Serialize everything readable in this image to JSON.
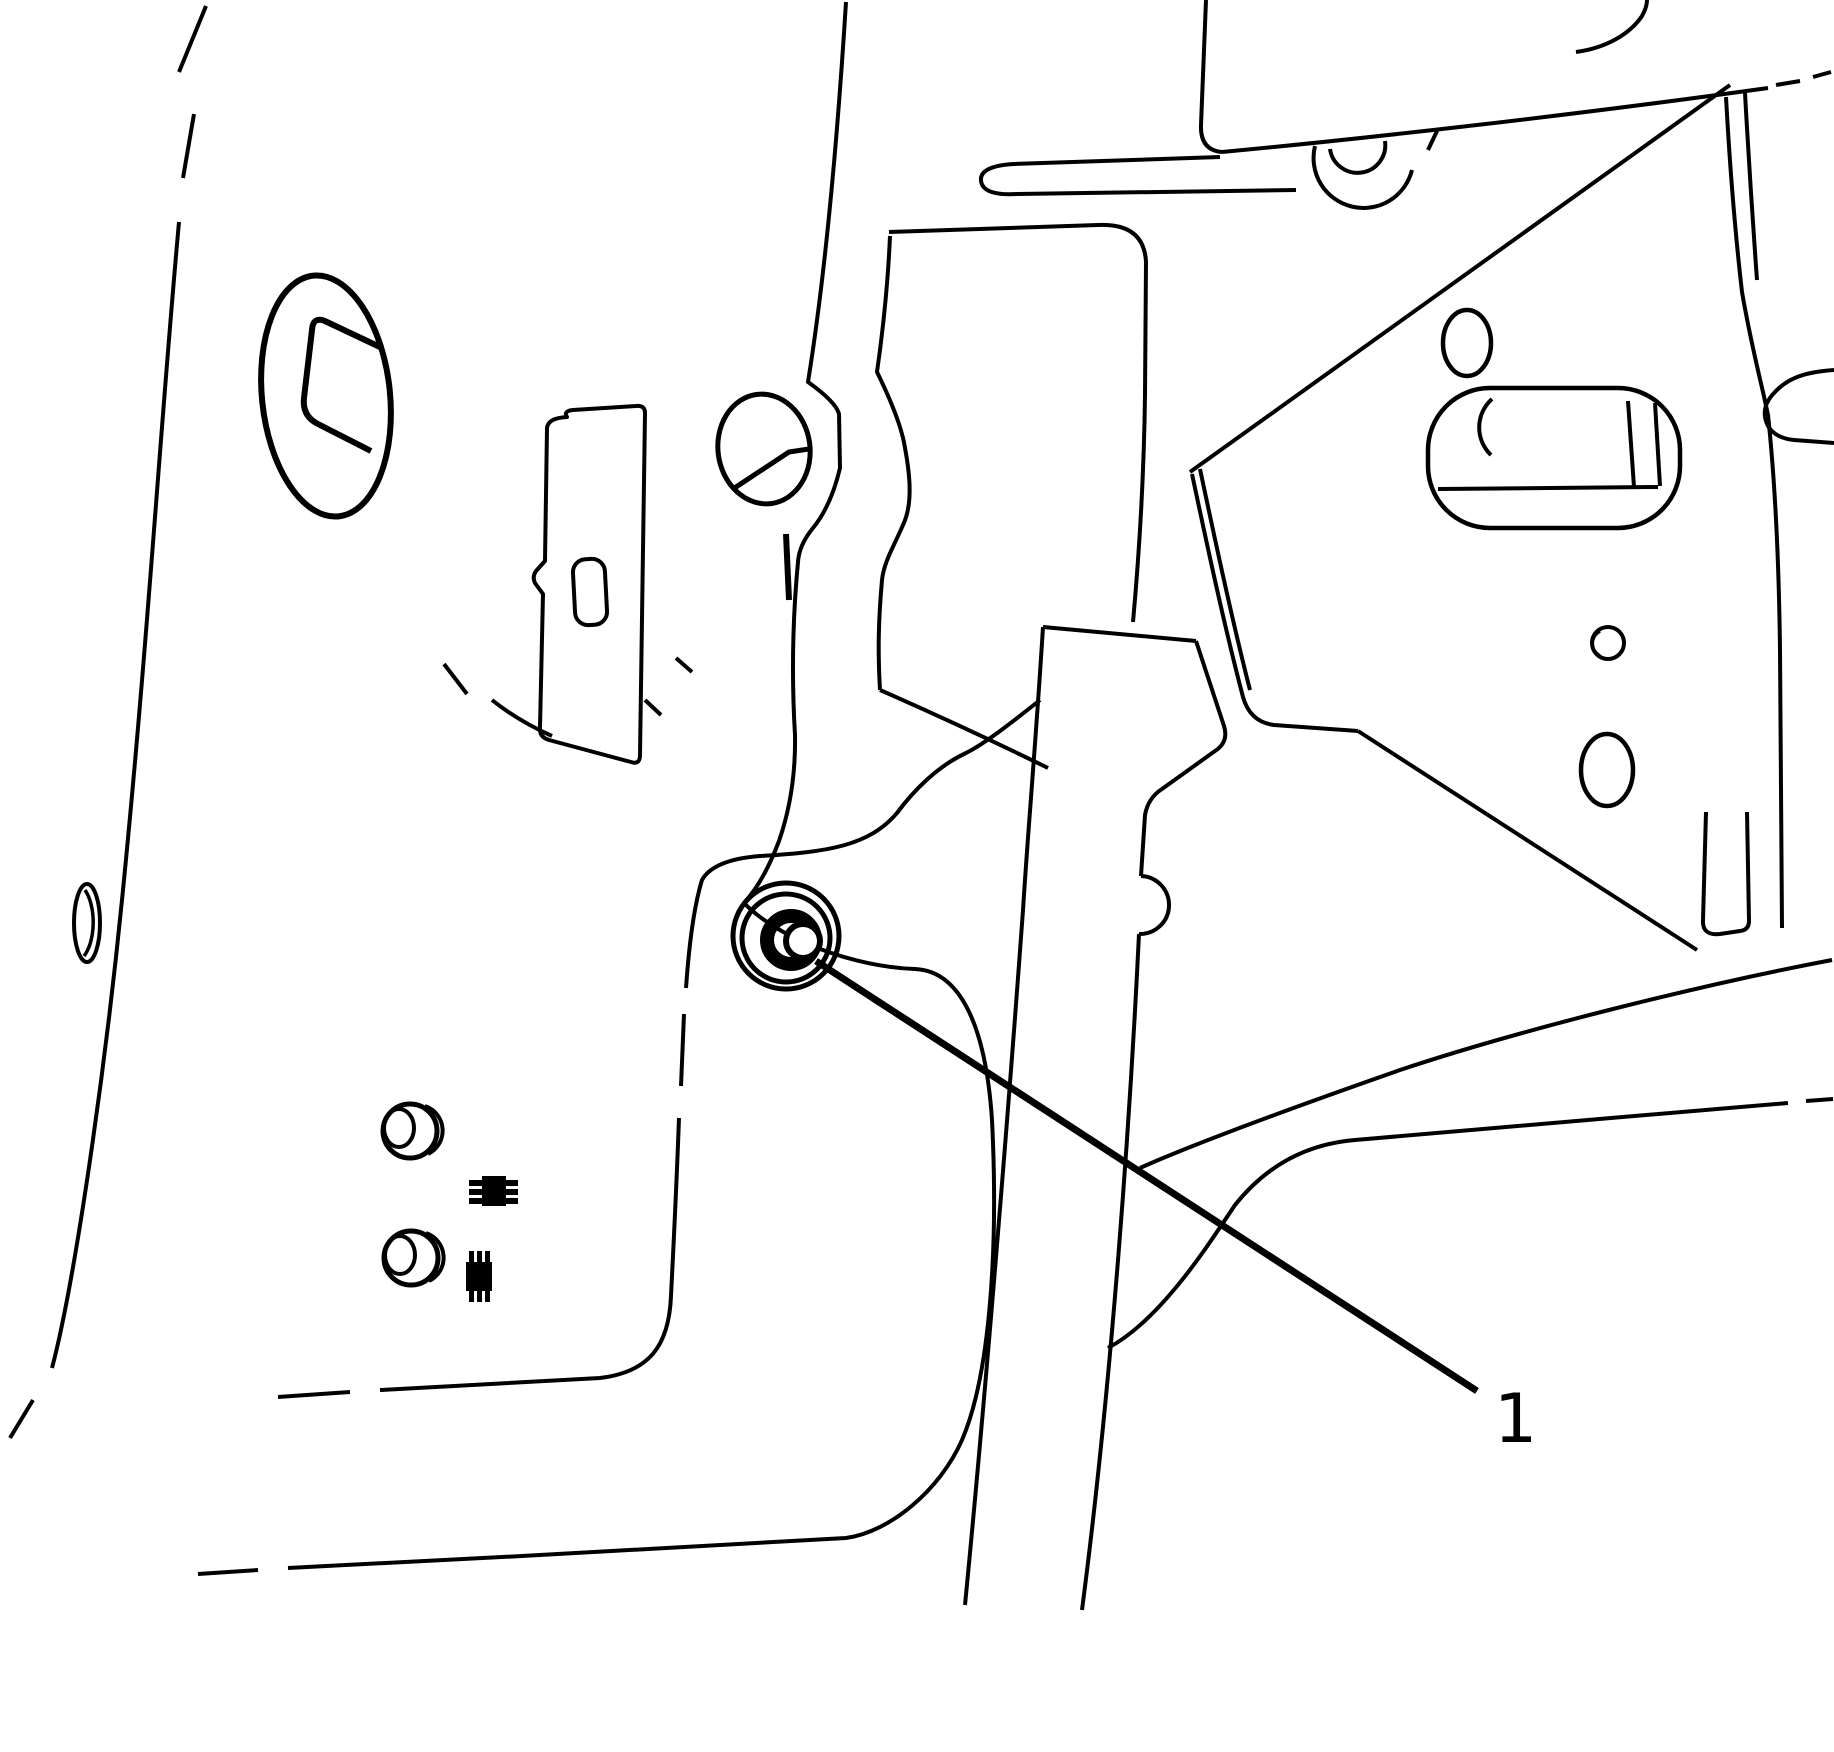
{
  "diagram": {
    "type": "technical-line-illustration",
    "background_color": "#ffffff",
    "line_color": "#000000",
    "callouts": [
      {
        "label": "1"
      }
    ]
  }
}
